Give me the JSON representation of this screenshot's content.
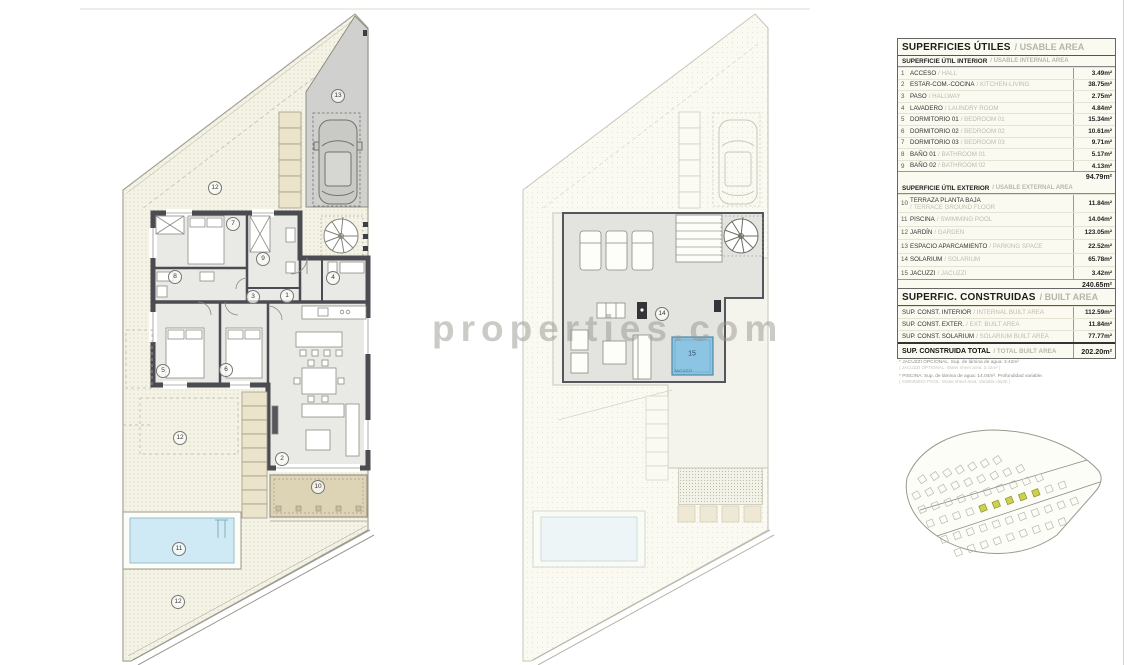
{
  "watermark": "properties.com",
  "labels": {
    "n1": "1",
    "n2": "2",
    "n3": "3",
    "n4": "4",
    "n5": "5",
    "n6": "6",
    "n7": "7",
    "n8": "8",
    "n9": "9",
    "n10": "10",
    "n11": "11",
    "n12": "12",
    "n13": "13",
    "n14": "14",
    "n15": "15",
    "jacuzzi_caption": "JACUZZI"
  },
  "usable": {
    "title_es": "SUPERFICIES ÚTILES",
    "title_en": "/ USABLE AREA",
    "interior_es": "SUPERFICIE ÚTIL INTERIOR",
    "interior_en": "/ USABLE INTERNAL AREA",
    "interior_rows": [
      {
        "n": "1",
        "es": "ACCESO",
        "en": "/ HALL",
        "v": "3.49m²"
      },
      {
        "n": "2",
        "es": "ESTAR-COM.-COCINA",
        "en": "/ KITCHEN-LIVING",
        "v": "38.75m²"
      },
      {
        "n": "3",
        "es": "PASO",
        "en": "/ HALLWAY",
        "v": "2.75m²"
      },
      {
        "n": "4",
        "es": "LAVADERO",
        "en": "/ LAUNDRY ROOM",
        "v": "4.84m²"
      },
      {
        "n": "5",
        "es": "DORMITORIO 01",
        "en": "/ BEDROOM 01",
        "v": "15.34m²"
      },
      {
        "n": "6",
        "es": "DORMITORIO 02",
        "en": "/ BEDROOM 02",
        "v": "10.61m²"
      },
      {
        "n": "7",
        "es": "DORMITORIO 03",
        "en": "/ BEDROOM 03",
        "v": "9.71m²"
      },
      {
        "n": "8",
        "es": "BAÑO 01",
        "en": "/ BATHROOM 01",
        "v": "5.17m²"
      },
      {
        "n": "9",
        "es": "BAÑO 02",
        "en": "/ BATHROOM 02",
        "v": "4.13m²"
      }
    ],
    "interior_total": "94.79m²",
    "exterior_es": "SUPERFICIE ÚTIL EXTERIOR",
    "exterior_en": "/ USABLE EXTERNAL AREA",
    "exterior_rows": [
      {
        "n": "10",
        "es": "TERRAZA PLANTA BAJA",
        "en": "/ TERRACE GROUND FLOOR",
        "v": "11.84m²"
      },
      {
        "n": "11",
        "es": "PISCINA",
        "en": "/ SWIMMING POOL",
        "v": "14.04m²"
      },
      {
        "n": "12",
        "es": "JARDÍN",
        "en": "/ GARDEN",
        "v": "123.05m²"
      },
      {
        "n": "13",
        "es": "ESPACIO APARCAMIENTO",
        "en": "/ PARKING SPACE",
        "v": "22.52m²"
      },
      {
        "n": "14",
        "es": "SOLARIUM",
        "en": "/ SOLARIUM",
        "v": "65.78m²"
      },
      {
        "n": "15",
        "es": "JACUZZI",
        "en": "/ JACUZZI",
        "v": "3.42m²"
      }
    ],
    "exterior_total": "240.65m²",
    "total_es": "SUPERFICIE ÚTIL TOTAL",
    "total_en": "/ TOTAL USABLE AREA",
    "total_v": "335.44m²"
  },
  "built": {
    "title_es": "SUPERFIC. CONSTRUIDAS",
    "title_en": "/ BUILT AREA",
    "rows": [
      {
        "es": "SUP. CONST. INTERIOR",
        "en": "/ INTERNAL BUILT AREA",
        "v": "112.59m²"
      },
      {
        "es": "SUP. CONST. EXTER.",
        "en": "/ EXT. BUILT AREA",
        "v": "11.84m²"
      },
      {
        "es": "SUP. CONST. SOLARIUM",
        "en": "/ SOLARIUM BUILT AREA",
        "v": "77.77m²"
      }
    ],
    "total_es": "SUP. CONSTRUIDA TOTAL",
    "total_en": "/ TOTAL BUILT AREA",
    "total_v": "202.20m²"
  },
  "footnotes": [
    {
      "main": "* JACUZZI OPCIONAL. Sup. de lámina de agua: 3.42m²",
      "sub": "( JACUZZI OPTIONAL. Water sheet area: 3.42m² )"
    },
    {
      "main": "* PISCINA: Sup. de lámina de agua: 14.04m². Profundidad variable.",
      "sub": "( SWIMMING POOL: Water sheet area. Variable depth )"
    }
  ]
}
